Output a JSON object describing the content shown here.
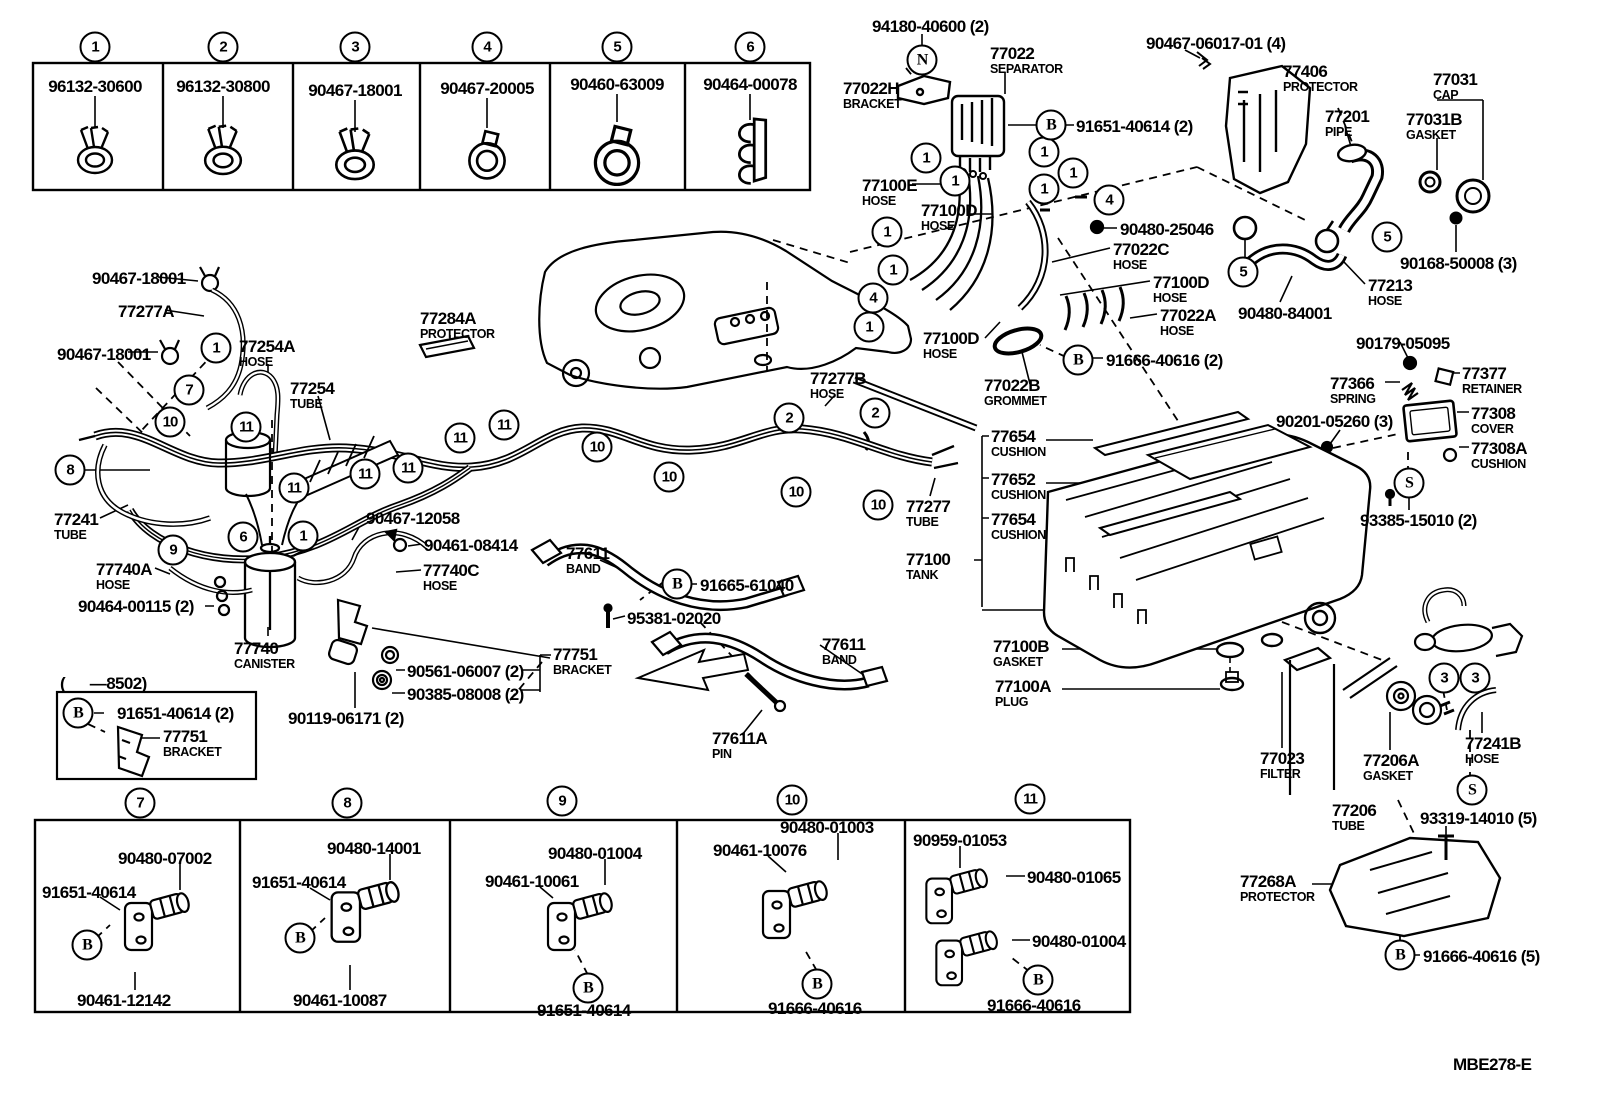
{
  "page": {
    "background": "#ffffff",
    "ink": "#000000",
    "drawing_code": "MBE278-E"
  },
  "labels": [
    {
      "t": "96132-30600",
      "x": 95,
      "y": 78,
      "c": 1
    },
    {
      "t": "96132-30800",
      "x": 223,
      "y": 78,
      "c": 1
    },
    {
      "t": "90467-18001",
      "x": 355,
      "y": 82,
      "c": 1
    },
    {
      "t": "90467-20005",
      "x": 487,
      "y": 80,
      "c": 1
    },
    {
      "t": "90460-63009",
      "x": 617,
      "y": 76,
      "c": 1
    },
    {
      "t": "90464-00078",
      "x": 750,
      "y": 76,
      "c": 1
    },
    {
      "t": "94180-40600 (2)",
      "x": 872,
      "y": 18
    },
    {
      "t": "77022",
      "s": "SEPARATOR",
      "x": 990,
      "y": 45
    },
    {
      "t": "77022H",
      "s": "BRACKET",
      "x": 843,
      "y": 80
    },
    {
      "t": "91651-40614 (2)",
      "x": 1076,
      "y": 118
    },
    {
      "t": "77100E",
      "s": "HOSE",
      "x": 862,
      "y": 177
    },
    {
      "t": "77100D",
      "s": "HOSE",
      "x": 921,
      "y": 202
    },
    {
      "t": "77100D",
      "s": "HOSE",
      "x": 923,
      "y": 330
    },
    {
      "t": "77022B",
      "s": "GROMMET",
      "x": 984,
      "y": 377
    },
    {
      "t": "91666-40616 (2)",
      "x": 1106,
      "y": 352
    },
    {
      "t": "90480-25046",
      "x": 1120,
      "y": 221
    },
    {
      "t": "77022C",
      "s": "HOSE",
      "x": 1113,
      "y": 241
    },
    {
      "t": "77100D",
      "s": "HOSE",
      "x": 1153,
      "y": 274
    },
    {
      "t": "77022A",
      "s": "HOSE",
      "x": 1160,
      "y": 307
    },
    {
      "t": "90480-84001",
      "x": 1238,
      "y": 305
    },
    {
      "t": "77213",
      "s": "HOSE",
      "x": 1368,
      "y": 277
    },
    {
      "t": "90168-50008 (3)",
      "x": 1400,
      "y": 255
    },
    {
      "t": "90467-06017-01 (4)",
      "x": 1146,
      "y": 35
    },
    {
      "t": "77406",
      "s": "PROTECTOR",
      "x": 1283,
      "y": 63
    },
    {
      "t": "77201",
      "s": "PIPE",
      "x": 1325,
      "y": 108
    },
    {
      "t": "77031",
      "s": "CAP",
      "x": 1433,
      "y": 71
    },
    {
      "t": "77031B",
      "s": "GASKET",
      "x": 1406,
      "y": 111
    },
    {
      "t": "90179-05095",
      "x": 1356,
      "y": 335
    },
    {
      "t": "77366",
      "s": "SPRING",
      "x": 1330,
      "y": 375
    },
    {
      "t": "77377",
      "s": "RETAINER",
      "x": 1462,
      "y": 365
    },
    {
      "t": "90201-05260 (3)",
      "x": 1276,
      "y": 413
    },
    {
      "t": "77308",
      "s": "COVER",
      "x": 1471,
      "y": 405
    },
    {
      "t": "77308A",
      "s": "CUSHION",
      "x": 1471,
      "y": 440
    },
    {
      "t": "93385-15010 (2)",
      "x": 1360,
      "y": 512
    },
    {
      "t": "90467-18001",
      "x": 92,
      "y": 270
    },
    {
      "t": "77277A",
      "x": 118,
      "y": 303
    },
    {
      "t": "90467-18001",
      "x": 57,
      "y": 346
    },
    {
      "t": "77254A",
      "s": "HOSE",
      "x": 239,
      "y": 338
    },
    {
      "t": "77284A",
      "s": "PROTECTOR",
      "x": 420,
      "y": 310
    },
    {
      "t": "77254",
      "s": "TUBE",
      "x": 290,
      "y": 380
    },
    {
      "t": "77277B",
      "s": "HOSE",
      "x": 810,
      "y": 370
    },
    {
      "t": "77277",
      "s": "TUBE",
      "x": 906,
      "y": 498
    },
    {
      "t": "77241",
      "s": "TUBE",
      "x": 54,
      "y": 511
    },
    {
      "t": "77740A",
      "s": "HOSE",
      "x": 96,
      "y": 561
    },
    {
      "t": "90464-00115 (2)",
      "x": 78,
      "y": 598
    },
    {
      "t": "77740",
      "s": "CANISTER",
      "x": 234,
      "y": 640
    },
    {
      "t": "90467-12058",
      "x": 366,
      "y": 510
    },
    {
      "t": "90461-08414",
      "x": 424,
      "y": 537
    },
    {
      "t": "77740C",
      "s": "HOSE",
      "x": 423,
      "y": 562
    },
    {
      "t": "77611",
      "s": "BAND",
      "x": 566,
      "y": 545
    },
    {
      "t": "91665-61040",
      "x": 700,
      "y": 577
    },
    {
      "t": "95381-02020",
      "x": 627,
      "y": 610
    },
    {
      "t": "77751",
      "s": "BRACKET",
      "x": 553,
      "y": 646
    },
    {
      "t": "90561-06007 (2)",
      "x": 407,
      "y": 663
    },
    {
      "t": "90385-08008 (2)",
      "x": 407,
      "y": 686
    },
    {
      "t": "90119-06171 (2)",
      "x": 288,
      "y": 710
    },
    {
      "t": "77611",
      "s": "BAND",
      "x": 822,
      "y": 636
    },
    {
      "t": "77611A",
      "s": "PIN",
      "x": 712,
      "y": 730
    },
    {
      "t": "(      —8502)",
      "x": 60,
      "y": 675
    },
    {
      "t": "91651-40614 (2)",
      "x": 117,
      "y": 705
    },
    {
      "t": "77751",
      "s": "BRACKET",
      "x": 163,
      "y": 728
    },
    {
      "t": "77654",
      "s": "CUSHION",
      "x": 991,
      "y": 428
    },
    {
      "t": "77652",
      "s": "CUSHION",
      "x": 991,
      "y": 471
    },
    {
      "t": "77654",
      "s": "CUSHION",
      "x": 991,
      "y": 511
    },
    {
      "t": "77100",
      "s": "TANK",
      "x": 906,
      "y": 551
    },
    {
      "t": "77100B",
      "s": "GASKET",
      "x": 993,
      "y": 638
    },
    {
      "t": "77100A",
      "s": "PLUG",
      "x": 995,
      "y": 678
    },
    {
      "t": "77023",
      "s": "FILTER",
      "x": 1260,
      "y": 750
    },
    {
      "t": "77206A",
      "s": "GASKET",
      "x": 1363,
      "y": 752
    },
    {
      "t": "77206",
      "s": "TUBE",
      "x": 1332,
      "y": 802
    },
    {
      "t": "93319-14010 (5)",
      "x": 1420,
      "y": 810
    },
    {
      "t": "77241B",
      "s": "HOSE",
      "x": 1465,
      "y": 735
    },
    {
      "t": "77268A",
      "s": "PROTECTOR",
      "x": 1240,
      "y": 873
    },
    {
      "t": "91666-40616 (5)",
      "x": 1423,
      "y": 948
    },
    {
      "t": "MBE278-E",
      "x": 1453,
      "y": 1056
    },
    {
      "t": "90480-07002",
      "x": 118,
      "y": 850
    },
    {
      "t": "91651-40614",
      "x": 42,
      "y": 884
    },
    {
      "t": "90461-12142",
      "x": 77,
      "y": 992
    },
    {
      "t": "90480-14001",
      "x": 327,
      "y": 840
    },
    {
      "t": "91651-40614",
      "x": 252,
      "y": 874
    },
    {
      "t": "90461-10087",
      "x": 293,
      "y": 992
    },
    {
      "t": "90480-01004",
      "x": 548,
      "y": 845
    },
    {
      "t": "90461-10061",
      "x": 485,
      "y": 873
    },
    {
      "t": "91651-40614",
      "x": 537,
      "y": 1002
    },
    {
      "t": "90480-01003",
      "x": 780,
      "y": 819
    },
    {
      "t": "90461-10076",
      "x": 713,
      "y": 842
    },
    {
      "t": "91666-40616",
      "x": 768,
      "y": 1000
    },
    {
      "t": "90959-01053",
      "x": 913,
      "y": 832
    },
    {
      "t": "90480-01065",
      "x": 1027,
      "y": 869
    },
    {
      "t": "90480-01004",
      "x": 1032,
      "y": 933
    },
    {
      "t": "91666-40616",
      "x": 987,
      "y": 997
    }
  ],
  "callouts": [
    {
      "v": "1",
      "x": 95,
      "y": 47
    },
    {
      "v": "2",
      "x": 223,
      "y": 47
    },
    {
      "v": "3",
      "x": 355,
      "y": 47
    },
    {
      "v": "4",
      "x": 487,
      "y": 47
    },
    {
      "v": "5",
      "x": 617,
      "y": 47
    },
    {
      "v": "6",
      "x": 750,
      "y": 47
    },
    {
      "v": "7",
      "x": 140,
      "y": 803
    },
    {
      "v": "8",
      "x": 347,
      "y": 803
    },
    {
      "v": "9",
      "x": 562,
      "y": 801
    },
    {
      "v": "10",
      "x": 792,
      "y": 800
    },
    {
      "v": "11",
      "x": 1030,
      "y": 799
    },
    {
      "v": "1",
      "x": 926,
      "y": 158
    },
    {
      "v": "1",
      "x": 955,
      "y": 181
    },
    {
      "v": "1",
      "x": 1044,
      "y": 152
    },
    {
      "v": "1",
      "x": 1073,
      "y": 173
    },
    {
      "v": "1",
      "x": 1044,
      "y": 189
    },
    {
      "v": "4",
      "x": 1109,
      "y": 200
    },
    {
      "v": "1",
      "x": 887,
      "y": 232
    },
    {
      "v": "1",
      "x": 893,
      "y": 270
    },
    {
      "v": "4",
      "x": 873,
      "y": 298
    },
    {
      "v": "1",
      "x": 869,
      "y": 327
    },
    {
      "v": "5",
      "x": 1243,
      "y": 272
    },
    {
      "v": "5",
      "x": 1387,
      "y": 237
    },
    {
      "v": "1",
      "x": 216,
      "y": 348
    },
    {
      "v": "7",
      "x": 189,
      "y": 390
    },
    {
      "v": "10",
      "x": 170,
      "y": 422
    },
    {
      "v": "11",
      "x": 246,
      "y": 427
    },
    {
      "v": "8",
      "x": 70,
      "y": 470
    },
    {
      "v": "11",
      "x": 294,
      "y": 488
    },
    {
      "v": "9",
      "x": 173,
      "y": 550
    },
    {
      "v": "6",
      "x": 243,
      "y": 537
    },
    {
      "v": "1",
      "x": 303,
      "y": 536
    },
    {
      "v": "11",
      "x": 365,
      "y": 474
    },
    {
      "v": "11",
      "x": 408,
      "y": 468
    },
    {
      "v": "11",
      "x": 460,
      "y": 438
    },
    {
      "v": "11",
      "x": 504,
      "y": 425
    },
    {
      "v": "10",
      "x": 597,
      "y": 447
    },
    {
      "v": "10",
      "x": 669,
      "y": 477
    },
    {
      "v": "10",
      "x": 796,
      "y": 492
    },
    {
      "v": "10",
      "x": 878,
      "y": 505
    },
    {
      "v": "2",
      "x": 789,
      "y": 418
    },
    {
      "v": "2",
      "x": 875,
      "y": 413
    },
    {
      "v": "3",
      "x": 1444,
      "y": 678
    },
    {
      "v": "3",
      "x": 1475,
      "y": 678
    },
    {
      "v": "N",
      "x": 922,
      "y": 60
    },
    {
      "v": "B",
      "x": 1051,
      "y": 125
    },
    {
      "v": "B",
      "x": 1078,
      "y": 360
    },
    {
      "v": "B",
      "x": 677,
      "y": 584
    },
    {
      "v": "B",
      "x": 78,
      "y": 713
    },
    {
      "v": "S",
      "x": 1409,
      "y": 483
    },
    {
      "v": "S",
      "x": 1472,
      "y": 790
    },
    {
      "v": "B",
      "x": 1400,
      "y": 955
    },
    {
      "v": "B",
      "x": 87,
      "y": 945
    },
    {
      "v": "B",
      "x": 300,
      "y": 938
    },
    {
      "v": "B",
      "x": 588,
      "y": 988
    },
    {
      "v": "B",
      "x": 817,
      "y": 984
    },
    {
      "v": "B",
      "x": 1038,
      "y": 980
    }
  ]
}
